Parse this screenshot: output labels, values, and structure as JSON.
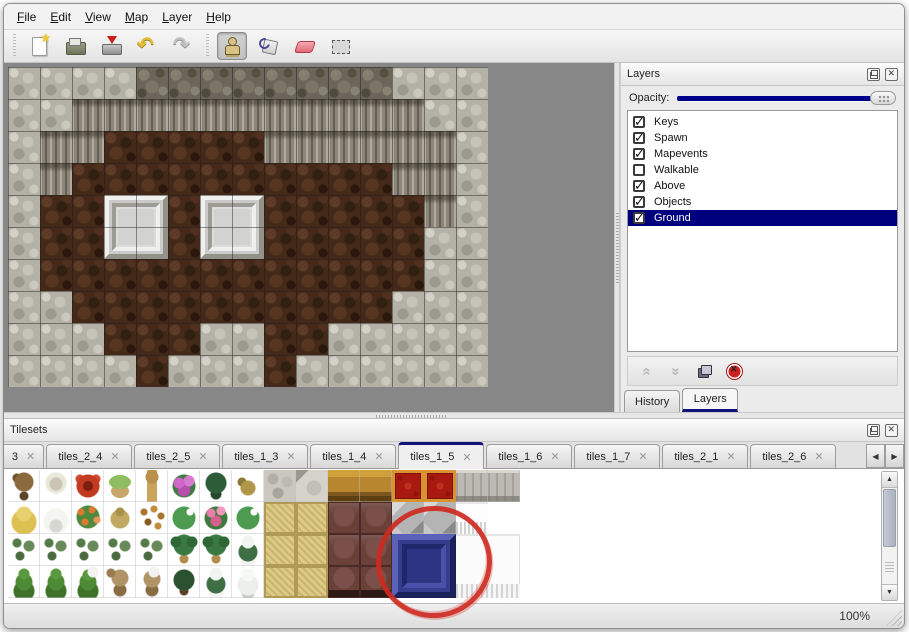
{
  "menubar": {
    "items": [
      "File",
      "Edit",
      "View",
      "Map",
      "Layer",
      "Help"
    ]
  },
  "toolbar": {
    "buttons": [
      {
        "name": "new-map-button",
        "icon": "new-page-icon",
        "active": false
      },
      {
        "name": "open-button",
        "icon": "open-folder-icon",
        "active": false
      },
      {
        "name": "save-button",
        "icon": "save-icon",
        "active": false
      },
      {
        "name": "undo-button",
        "icon": "undo-arrow-icon",
        "active": false
      },
      {
        "name": "redo-button",
        "icon": "redo-arrow-icon",
        "active": false
      },
      {
        "name": "stamp-tool-button",
        "icon": "stamp-person-icon",
        "active": true
      },
      {
        "name": "fill-tool-button",
        "icon": "paint-bucket-icon",
        "active": false
      },
      {
        "name": "eraser-tool-button",
        "icon": "eraser-icon",
        "active": false
      },
      {
        "name": "select-tool-button",
        "icon": "selection-rect-icon",
        "active": false
      }
    ],
    "separators_after": [
      -1,
      4
    ]
  },
  "layers_panel": {
    "title": "Layers",
    "opacity_label": "Opacity:",
    "opacity_percent": 100,
    "layers": [
      {
        "label": "Keys",
        "checked": true,
        "selected": false
      },
      {
        "label": "Spawn",
        "checked": true,
        "selected": false
      },
      {
        "label": "Mapevents",
        "checked": true,
        "selected": false
      },
      {
        "label": "Walkable",
        "checked": false,
        "selected": false
      },
      {
        "label": "Above",
        "checked": true,
        "selected": false
      },
      {
        "label": "Objects",
        "checked": true,
        "selected": false
      },
      {
        "label": "Ground",
        "checked": true,
        "selected": true
      }
    ],
    "tools": [
      {
        "name": "raise-layer-button",
        "icon": "chevrons-up-icon",
        "enabled": false
      },
      {
        "name": "lower-layer-button",
        "icon": "chevrons-down-icon",
        "enabled": false
      },
      {
        "name": "duplicate-layer-button",
        "icon": "duplicate-icon",
        "enabled": true
      },
      {
        "name": "delete-layer-button",
        "icon": "delete-circle-icon",
        "enabled": true
      }
    ],
    "tabs": [
      {
        "label": "History",
        "active": false
      },
      {
        "label": "Layers",
        "active": true
      }
    ]
  },
  "tilesets_panel": {
    "title": "Tilesets",
    "active_tab": "tiles_1_5",
    "tabs": [
      {
        "label": "3",
        "clipped": true
      },
      {
        "label": "tiles_2_4",
        "clipped": false
      },
      {
        "label": "tiles_2_5",
        "clipped": false
      },
      {
        "label": "tiles_1_3",
        "clipped": false
      },
      {
        "label": "tiles_1_4",
        "clipped": false
      },
      {
        "label": "tiles_1_5",
        "clipped": false
      },
      {
        "label": "tiles_1_6",
        "clipped": false
      },
      {
        "label": "tiles_1_7",
        "clipped": false
      },
      {
        "label": "tiles_2_1",
        "clipped": false
      },
      {
        "label": "tiles_2_6",
        "clipped": false
      }
    ],
    "scroll_left_icon": "◀",
    "scroll_right_icon": "▶"
  },
  "statusbar": {
    "zoom": "100%"
  },
  "map": {
    "tile_size": 32,
    "cols": 15,
    "rows": 10,
    "grid": [
      "GGGGDDDDDDDDGGG",
      "GGCCCCCCCCCCCGG",
      "GCCBBBBBCCCCCCG",
      "GCBBBBBBBBBBCCG",
      "GBBBBBBBBBBBBCG",
      "GBBBBBBBBBBBBGG",
      "GBBBBBBBBBBBBGG",
      "GGBBBBBBBBBBGGG",
      "GGGBBBGGBBGGGGG",
      "GGGGBGGGBGGGGGG"
    ],
    "blocks": [
      {
        "col": 3,
        "row": 4,
        "w": 2,
        "h": 2
      },
      {
        "col": 6,
        "row": 4,
        "w": 2,
        "h": 2
      }
    ]
  },
  "tileset_grid": {
    "tile_size": 32,
    "rows": [
      [
        "treeBare",
        "treeWhite",
        "flowerRed",
        "stump",
        "trunk",
        "bushPink",
        "palmDark",
        "plantSmall",
        "cobble",
        "cobble2",
        "wood",
        "wood",
        "carpet",
        "carpet",
        "stoneGray",
        "stoneGray"
      ],
      [
        "hay",
        "snowMound",
        "flowersOrange",
        "grassDry",
        "leaves",
        "lilyPad",
        "roses",
        "lilyPad",
        "mat",
        "mat",
        "leather",
        "leather",
        "gray3d",
        "gray3d",
        "fringe",
        "blank"
      ],
      [
        "sprouts",
        "sprouts",
        "sprouts",
        "sprouts",
        "sprouts",
        "palm",
        "palm",
        "pineSnow",
        "mat",
        "mat",
        "leather",
        "leather",
        "blank",
        "blank",
        "blank",
        "blank"
      ],
      [
        "bushCone",
        "bushCone",
        "bushConeSnow",
        "treeDead",
        "treeDeadSnow",
        "treeDark",
        "pineSnow",
        "pineSnowWhite",
        "mat",
        "mat",
        "leatherFoot",
        "leatherFoot",
        "blank",
        "blank",
        "blank",
        "blank"
      ]
    ],
    "overlays": [
      {
        "type": "blue-block",
        "col": 12,
        "row": 2,
        "w": 2,
        "h": 2,
        "selected": true
      },
      {
        "type": "curtain-block",
        "col": 14,
        "row": 2,
        "w": 2,
        "h": 2,
        "selected": false
      }
    ]
  },
  "annotation": {
    "type": "red-circle",
    "color": "#ce2a20",
    "target": "blue-block-tile"
  },
  "colors": {
    "accent_navy": "#00008c",
    "selection_navy": "#00007f",
    "canvas_gray": "#878787",
    "annotation_red": "#ce2a20"
  }
}
